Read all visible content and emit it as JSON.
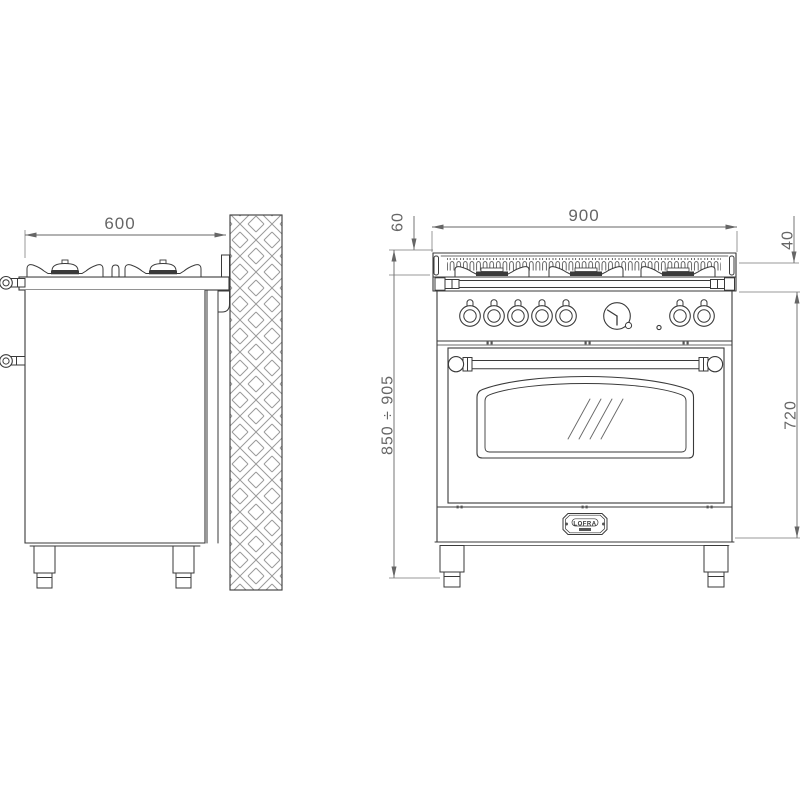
{
  "dimensions": {
    "side_width": "600",
    "front_width": "900",
    "grate_height": "60",
    "worktop_edge": "40",
    "overall_height": "850 ÷ 905",
    "body_height": "720"
  },
  "badge": {
    "brand": "LOFRA"
  }
}
